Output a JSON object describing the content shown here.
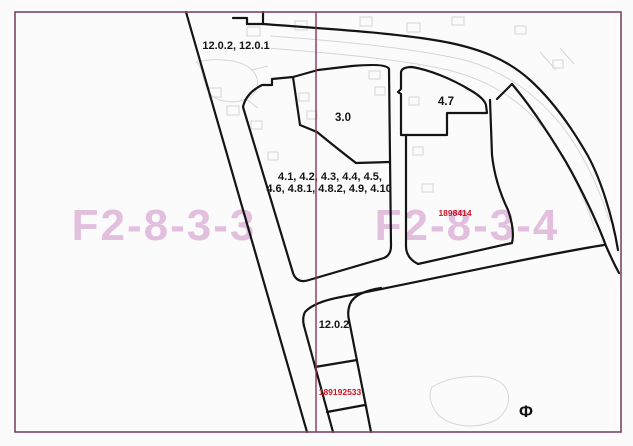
{
  "map": {
    "watermarks": {
      "left_sheet": "F2-8-3-3",
      "right_sheet": "F2-8-3-4"
    },
    "labels": {
      "top_road": "12.0.2, 12.0.1",
      "parcel_3_0": "3.0",
      "parcel_4_7": "4.7",
      "parcel_group_line1": "4.1, 4.2, 4.3, 4.4, 4.5,",
      "parcel_group_line2": "4.6, 4.8.1, 4.8.2, 4.9, 4.10",
      "bottom_road": "12.0.2",
      "phi_mark": "Φ"
    },
    "red_ids": {
      "id_upper": "1898414",
      "id_lower": "189192533"
    },
    "colors": {
      "paper": "#fcfbfc",
      "border": "#7d4563",
      "divider": "#8c3156",
      "watermark": "#d9a8d2",
      "red_id": "#cc1322",
      "outline": "#141414",
      "underlay": "#aaa6aa"
    }
  }
}
